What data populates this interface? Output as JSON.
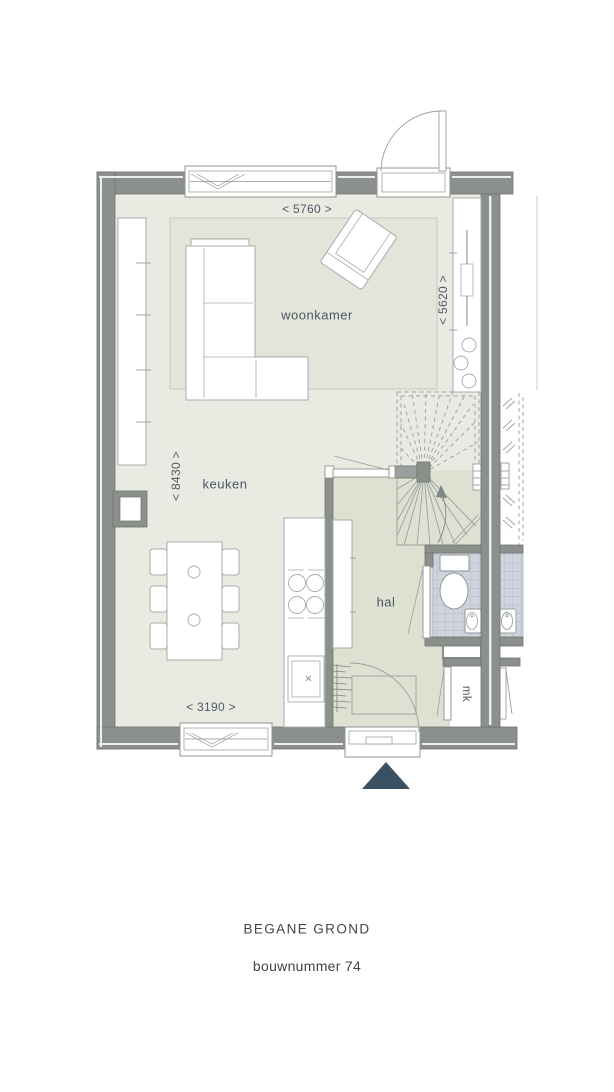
{
  "plan": {
    "labels": {
      "woonkamer": "woonkamer",
      "keuken": "keuken",
      "hal": "hal",
      "mk": "mk"
    },
    "dimensions": {
      "width_top": "< 5760 >",
      "height_right": "< 5620 >",
      "height_left": "< 8430 >",
      "width_bottom": "< 3190 >"
    }
  },
  "footer": {
    "title": "BEGANE GROND",
    "subtitle": "bouwnummer 74"
  },
  "colors": {
    "wall": "#8b908c",
    "floor": "#e9eae2",
    "floor_hal": "#dee0d1",
    "rug": "#e3e5db",
    "tile": "#cfd4de",
    "entrance_marker": "#3b5060",
    "text": "#4d5761"
  }
}
